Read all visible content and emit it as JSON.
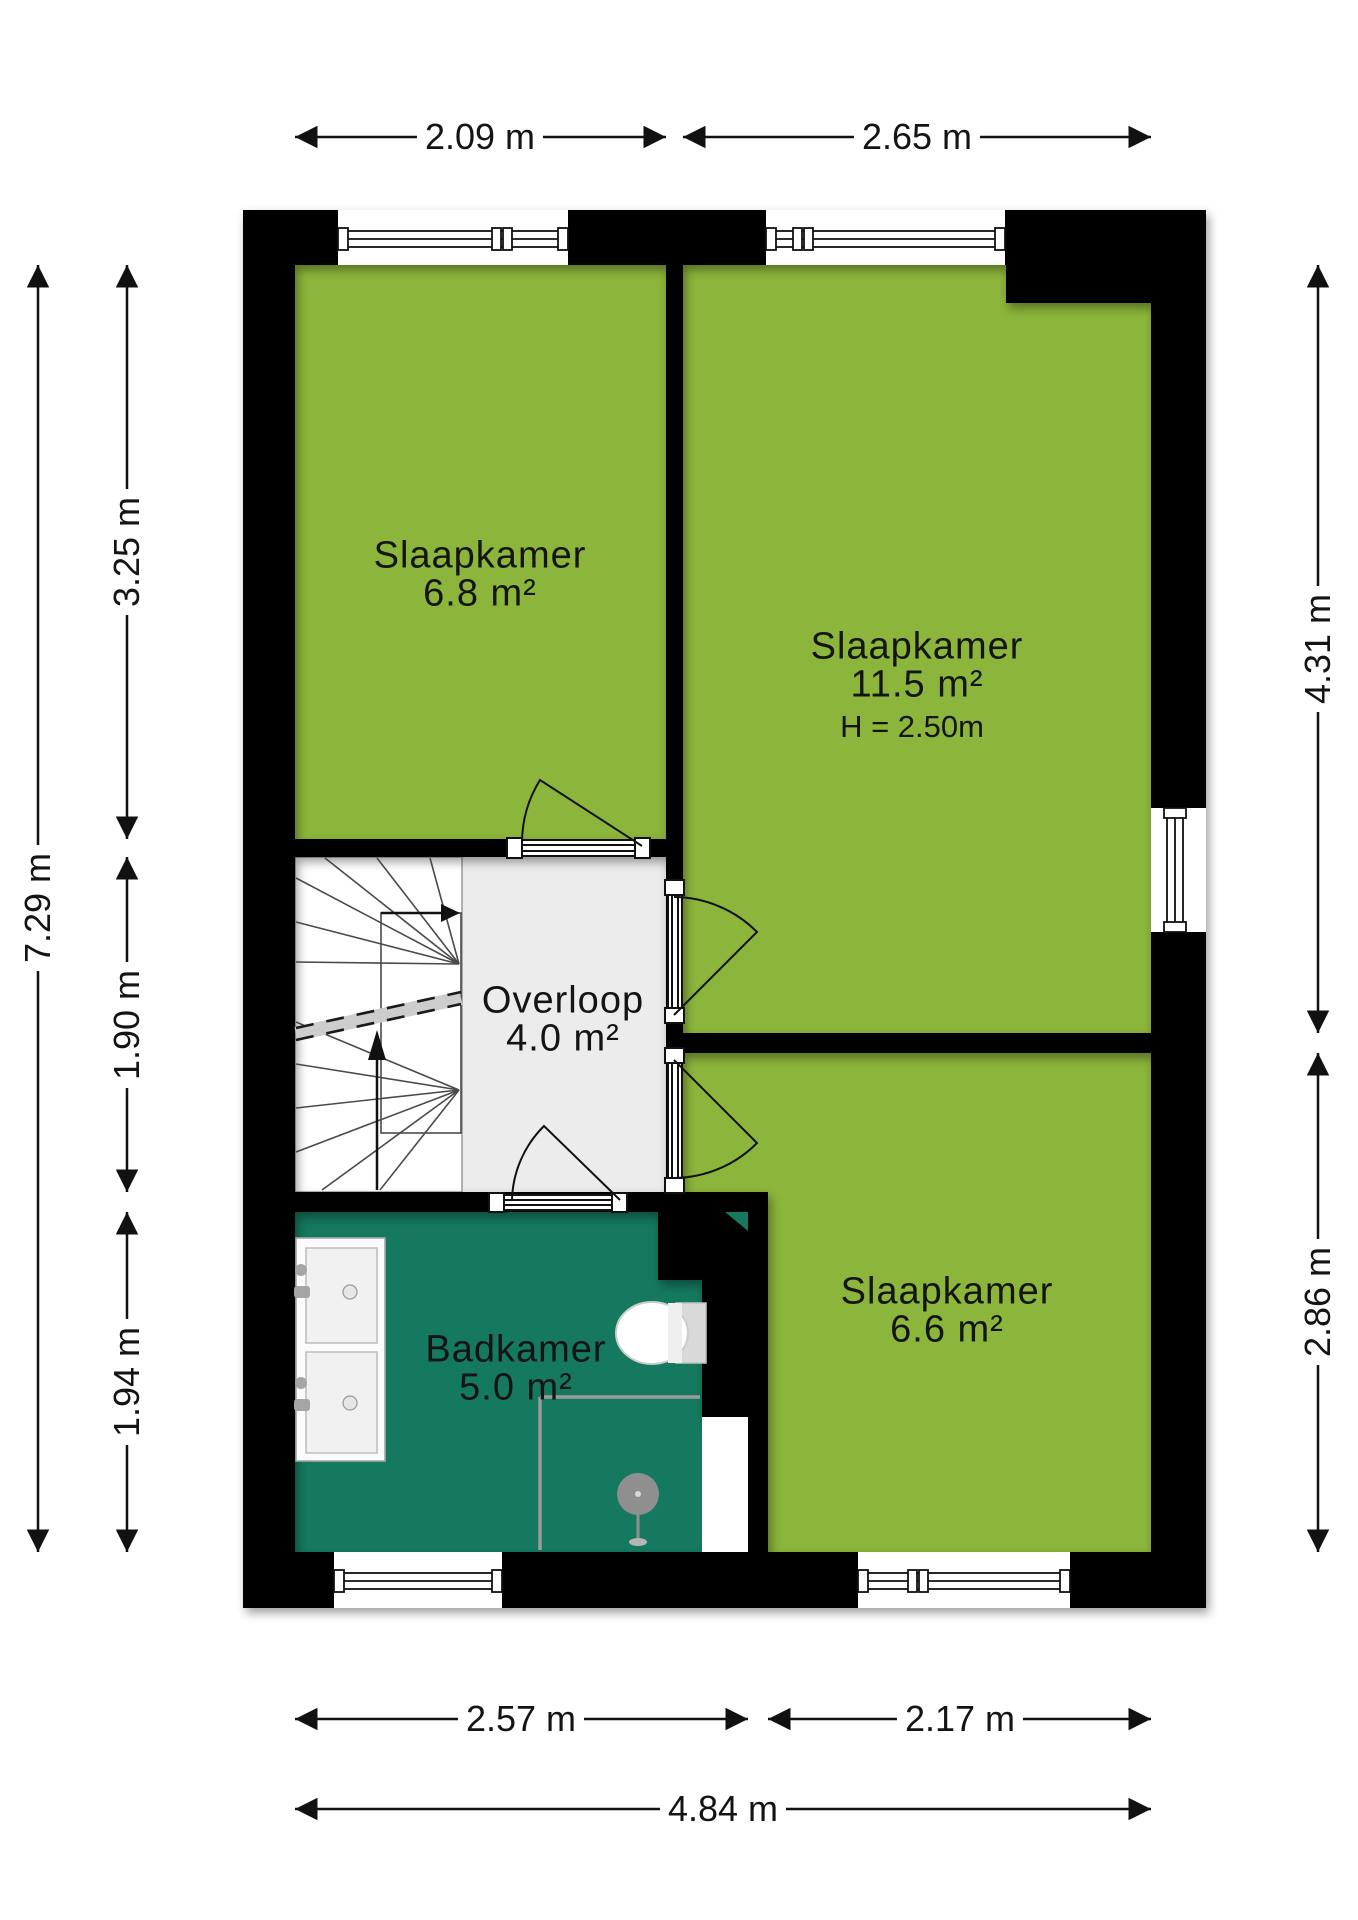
{
  "plan": {
    "title": "floor-plan-upper-floor",
    "rooms": [
      {
        "id": "slaapkamer-1",
        "name": "Slaapkamer",
        "area": "6.8 m²"
      },
      {
        "id": "slaapkamer-2",
        "name": "Slaapkamer",
        "area": "11.5 m²",
        "ceiling_height": "H = 2.50m"
      },
      {
        "id": "overloop",
        "name": "Overloop",
        "area": "4.0 m²"
      },
      {
        "id": "badkamer",
        "name": "Badkamer",
        "area": "5.0 m²"
      },
      {
        "id": "slaapkamer-3",
        "name": "Slaapkamer",
        "area": "6.6 m²"
      }
    ],
    "dimensions": {
      "top": [
        {
          "value": "2.09 m"
        },
        {
          "value": "2.65 m"
        }
      ],
      "left_inner": [
        {
          "value": "3.25 m"
        },
        {
          "value": "1.90 m"
        },
        {
          "value": "1.94 m"
        }
      ],
      "left_total": {
        "value": "7.29 m"
      },
      "right": [
        {
          "value": "4.31 m"
        },
        {
          "value": "2.86 m"
        }
      ],
      "bottom_inner": [
        {
          "value": "2.57 m"
        },
        {
          "value": "2.17 m"
        }
      ],
      "bottom_total": {
        "value": "4.84 m"
      }
    },
    "fixtures": [
      {
        "icon": "stairs-icon"
      },
      {
        "icon": "bathtub-vanity-icon"
      },
      {
        "icon": "toilet-icon"
      },
      {
        "icon": "shower-icon"
      }
    ],
    "colors": {
      "room_green": "#8CB53B",
      "bathroom_teal": "#14795F",
      "hallway_grey": "#ECECEC",
      "wall_black": "#000000"
    }
  }
}
